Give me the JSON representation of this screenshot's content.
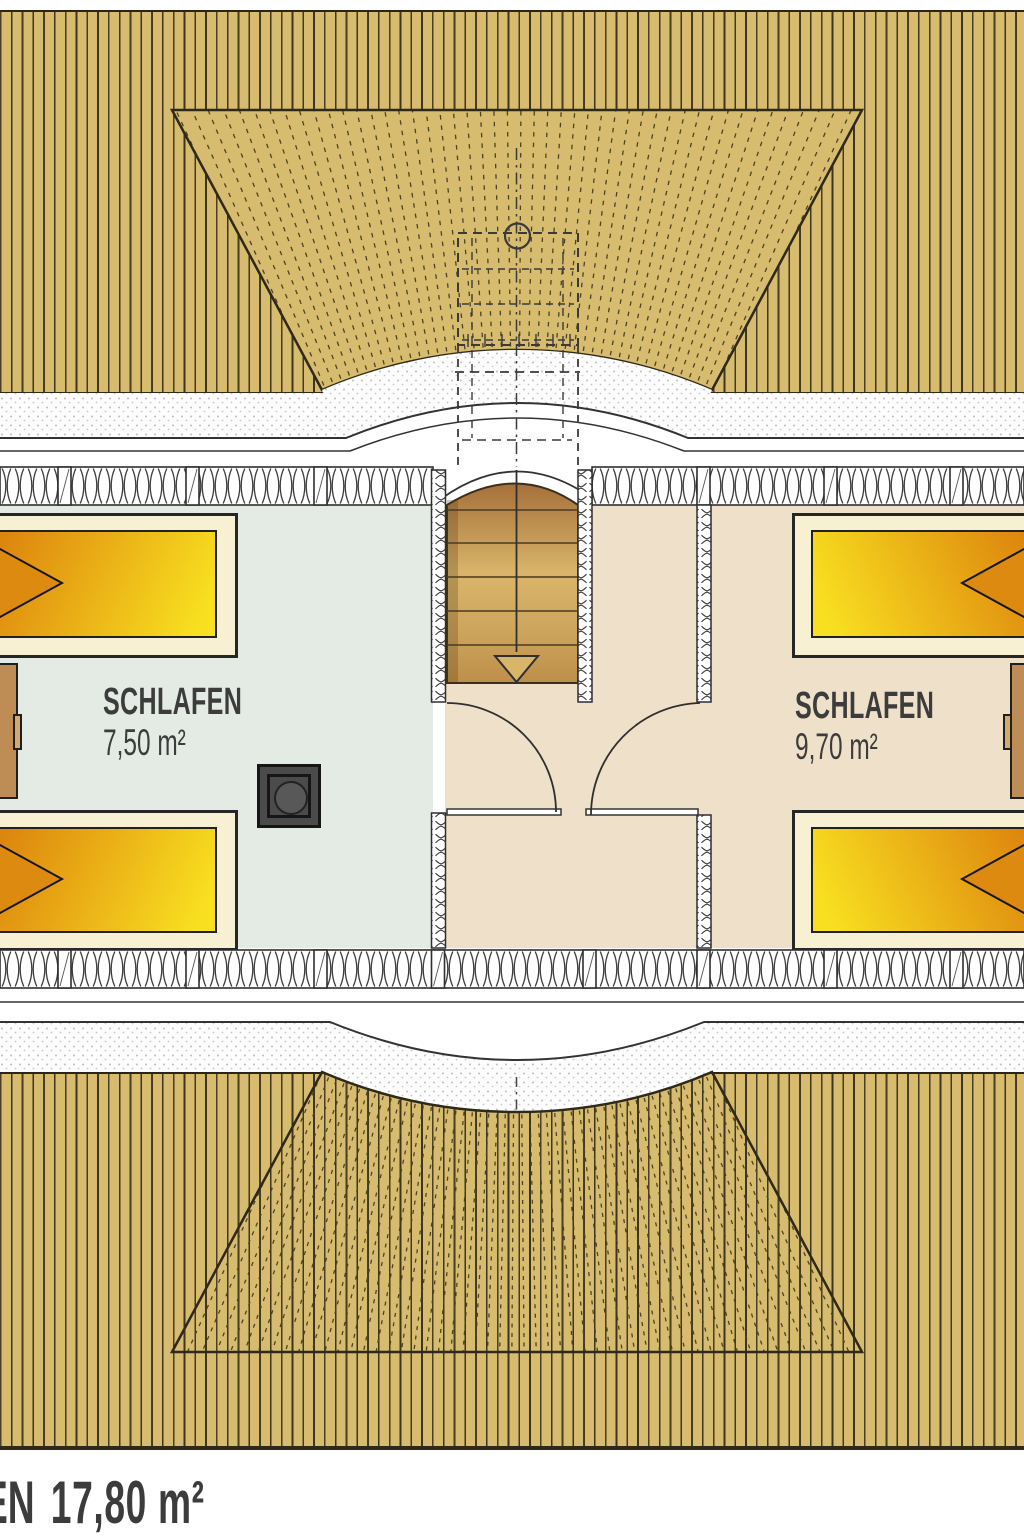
{
  "plan": {
    "type": "floor-plan",
    "language": "de",
    "rooms": [
      {
        "label": "SCHLAFEN",
        "area": "7,50 m²"
      },
      {
        "label": "SCHLAFEN",
        "area": "9,70 m²"
      }
    ],
    "footer": {
      "label_fragment": "EN",
      "area": "17,80 m²"
    },
    "colors": {
      "roof": "#d7bb6e",
      "roof_line": "#3d3520",
      "floor_left": "#e3ebe4",
      "floor_right": "#efe0ca",
      "bed_orange": "#de860f",
      "bed_yellow": "#f8df20",
      "bed_frame": "#f8f0d3",
      "stair_light": "#d9b56a",
      "stair_dark": "#a5703a",
      "wood": "#bd8d55",
      "ink": "#3c3c3c"
    }
  }
}
